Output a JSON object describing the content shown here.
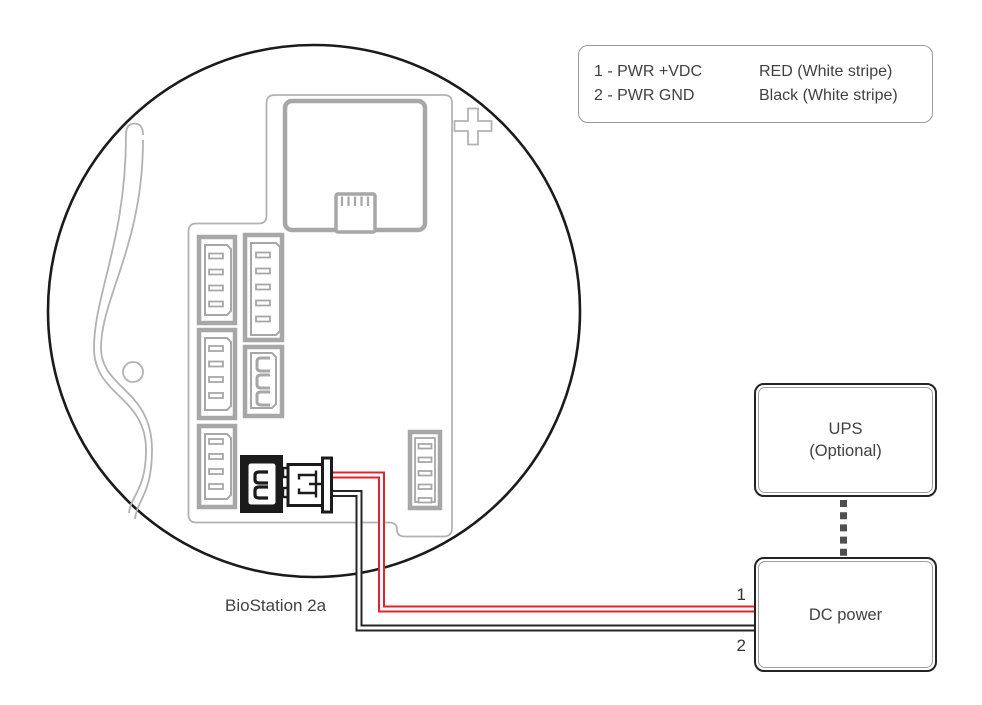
{
  "diagram": {
    "device_label": "BioStation 2a",
    "legend": {
      "rows": [
        {
          "pin": "1 - PWR +VDC",
          "wire": "RED (White stripe)"
        },
        {
          "pin": "2 - PWR GND",
          "wire": "Black (White stripe)"
        }
      ]
    },
    "boxes": {
      "ups": {
        "line1": "UPS",
        "line2": "(Optional)"
      },
      "dc": {
        "label": "DC power"
      }
    },
    "wires": [
      {
        "id": "pwr-vdc",
        "number": "1",
        "color": "#e62129"
      },
      {
        "id": "pwr-gnd",
        "number": "2",
        "color": "#262626"
      }
    ],
    "colors": {
      "art_gray": "#a7a7a7",
      "art_gray_thin": "#b2b2b2",
      "outline_black": "#1b1b1b",
      "text": "#414141"
    }
  }
}
